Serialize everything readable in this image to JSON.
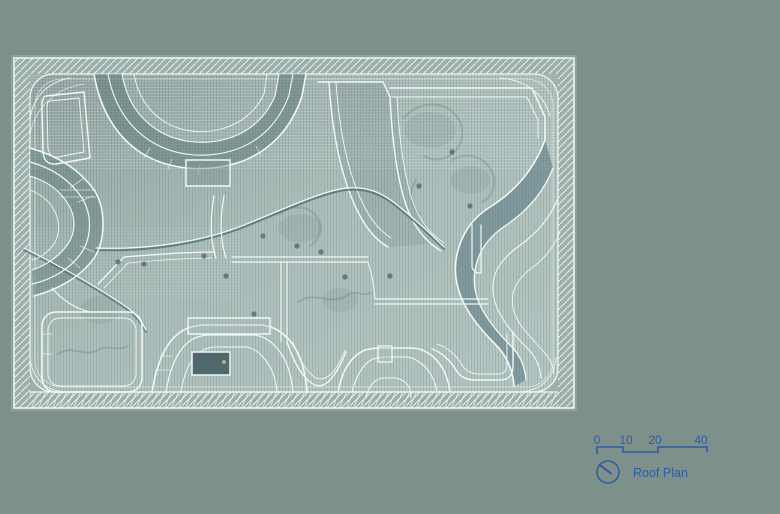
{
  "title": "Roof Plan",
  "drawing": {
    "kind": "architectural-roof-plan",
    "label": "Roof Plan"
  },
  "scale_bar": {
    "labels": [
      "0",
      "10",
      "20",
      "40"
    ]
  },
  "legend": {
    "label": "Roof Plan",
    "icon": "north-indicator-icon"
  },
  "colors": {
    "canvas-bg": "#7e908c",
    "sheet-light": "#b3c5c1",
    "frame-band": "#9cafab",
    "line-white": "#f3f8f6",
    "band-dark": "#5e7a79",
    "band-deep": "#50707b",
    "annotation-blue": "#2d5da1",
    "skylight-dark": "#4e6a6e",
    "accent-amber": "#c2a96b"
  }
}
